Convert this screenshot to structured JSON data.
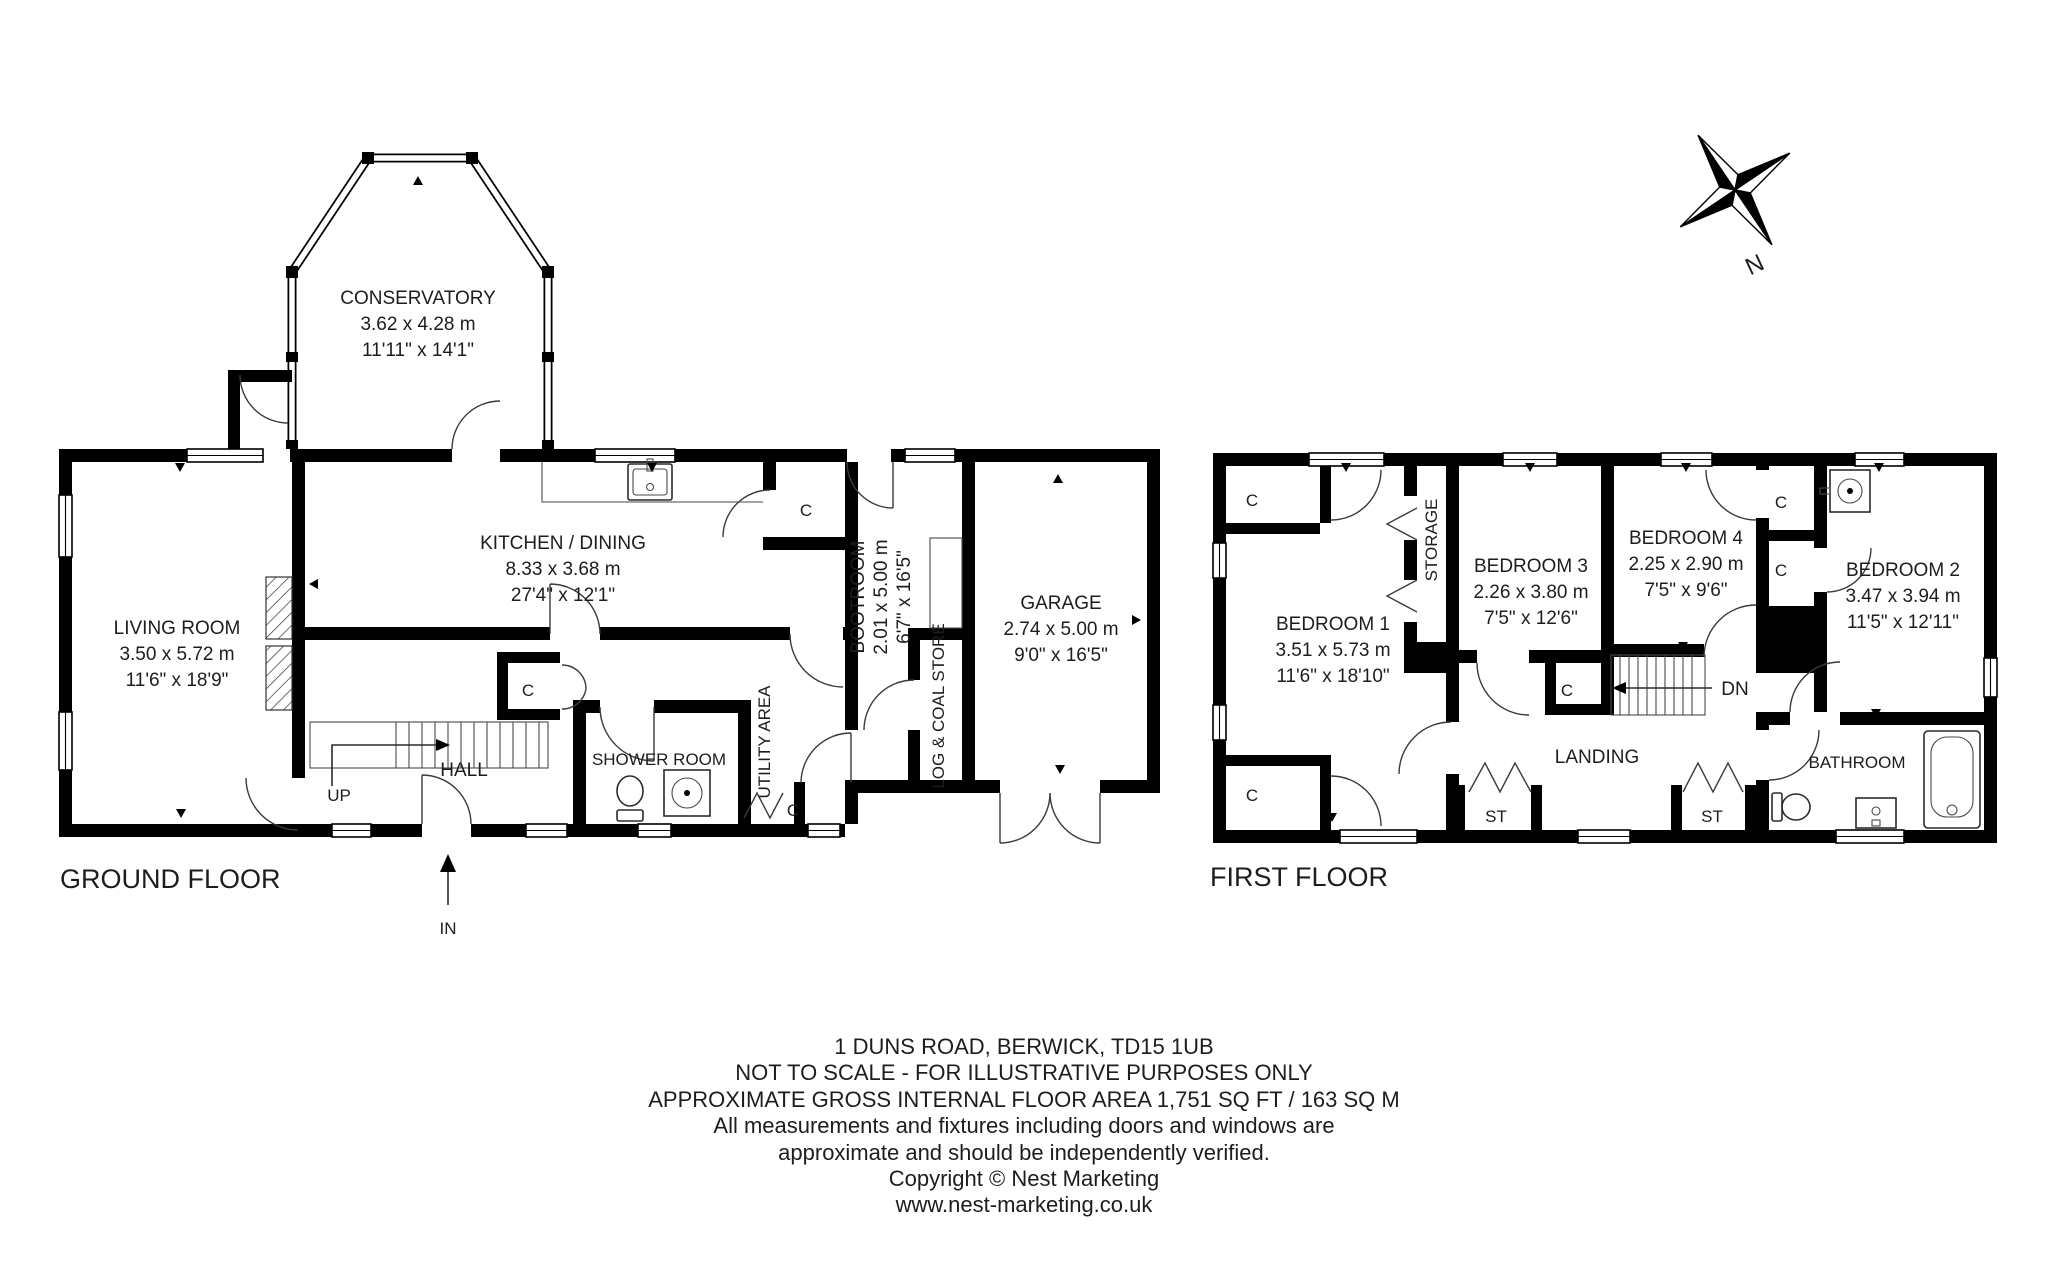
{
  "ground_floor": {
    "floor_label": "GROUND FLOOR",
    "up_label": "UP",
    "in_label": "IN",
    "cupboard": "C",
    "rooms": {
      "conservatory": {
        "name": "CONSERVATORY",
        "metric": "3.62 x 4.28 m",
        "imperial": "11'11\" x 14'1\""
      },
      "living_room": {
        "name": "LIVING ROOM",
        "metric": "3.50 x 5.72 m",
        "imperial": "11'6\" x 18'9\""
      },
      "kitchen_dining": {
        "name": "KITCHEN / DINING",
        "metric": "8.33 x 3.68 m",
        "imperial": "27'4\" x 12'1\""
      },
      "hall": {
        "name": "HALL"
      },
      "shower_room": {
        "name": "SHOWER ROOM"
      },
      "utility_area": {
        "name": "UTILITY AREA"
      },
      "bootroom": {
        "name": "BOOTROOM",
        "metric": "2.01 x 5.00 m",
        "imperial": "6'7\" x 16'5\""
      },
      "log_coal_store": {
        "name": "LOG & COAL STORE"
      },
      "garage": {
        "name": "GARAGE",
        "metric": "2.74 x 5.00 m",
        "imperial": "9'0\" x 16'5\""
      }
    }
  },
  "first_floor": {
    "floor_label": "FIRST FLOOR",
    "dn_label": "DN",
    "cupboard": "C",
    "store": "ST",
    "rooms": {
      "bedroom_1": {
        "name": "BEDROOM 1",
        "metric": "3.51 x 5.73 m",
        "imperial": "11'6\" x 18'10\""
      },
      "bedroom_2": {
        "name": "BEDROOM 2",
        "metric": "3.47 x 3.94 m",
        "imperial": "11'5\" x 12'11\""
      },
      "bedroom_3": {
        "name": "BEDROOM 3",
        "metric": "2.26 x 3.80 m",
        "imperial": "7'5\" x 12'6\""
      },
      "bedroom_4": {
        "name": "BEDROOM 4",
        "metric": "2.25 x 2.90 m",
        "imperial": "7'5\" x 9'6\""
      },
      "storage": {
        "name": "STORAGE"
      },
      "landing": {
        "name": "LANDING"
      },
      "bathroom": {
        "name": "BATHROOM"
      }
    }
  },
  "compass": {
    "north": "N"
  },
  "footer": {
    "lines": [
      "1 DUNS ROAD, BERWICK, TD15 1UB",
      "NOT TO SCALE - FOR ILLUSTRATIVE PURPOSES ONLY",
      "APPROXIMATE GROSS INTERNAL FLOOR AREA 1,751 SQ FT / 163 SQ M",
      "All measurements and fixtures including doors and windows are",
      "approximate and should be independently verified.",
      "Copyright © Nest Marketing",
      "www.nest-marketing.co.uk"
    ]
  }
}
